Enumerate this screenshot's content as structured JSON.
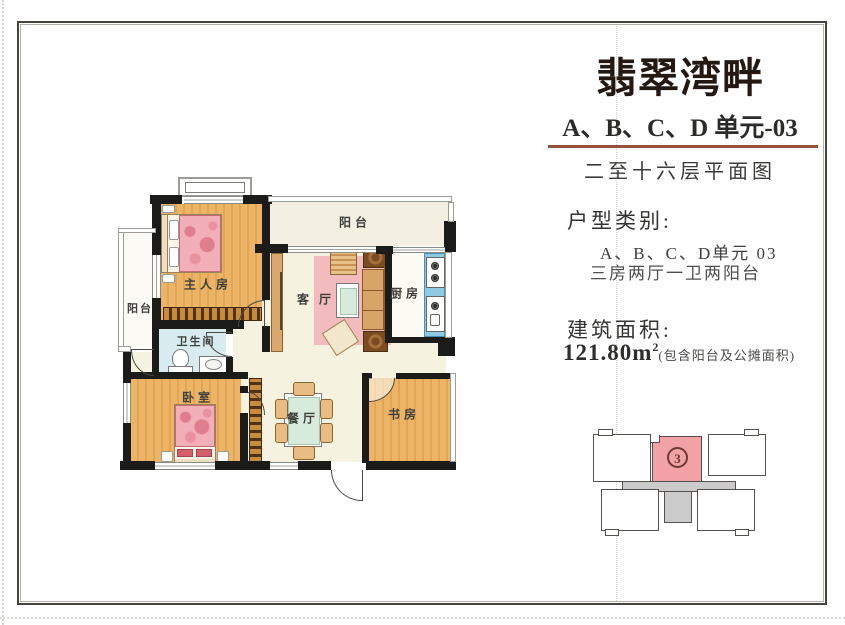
{
  "header": {
    "title": "翡翠湾畔",
    "subtitle": "A、B、C、D 单元-03",
    "plan_caption": "二至十六层平面图"
  },
  "details": {
    "type_label": "户型类别:",
    "type_unit": "A、B、C、D单元 03",
    "type_layout": "三房两厅一卫两阳台",
    "area_label": "建筑面积:",
    "area_value": "121.80m",
    "area_superscript": "2",
    "area_note": "(包含阳台及公摊面积)"
  },
  "floorplan": {
    "rooms": {
      "balcony_top": "阳台",
      "master_bedroom": "主人房",
      "balcony_left": "阳台",
      "living_room": "客厅",
      "kitchen": "厨房",
      "bathroom": "卫生间",
      "bedroom": "卧室",
      "dining_room": "餐厅",
      "study": "书房"
    }
  },
  "keyplan": {
    "highlighted_unit": "3"
  },
  "colors": {
    "rule_brown": "#94523B",
    "wood_floor": "#ECB466",
    "rug_pink": "#F3BBBD",
    "bathroom_blue": "#D8ECEF",
    "counter_blue": "#8FC9E4",
    "keyplan_pink": "#F2A2A6",
    "wall_black": "#1B1B19"
  }
}
